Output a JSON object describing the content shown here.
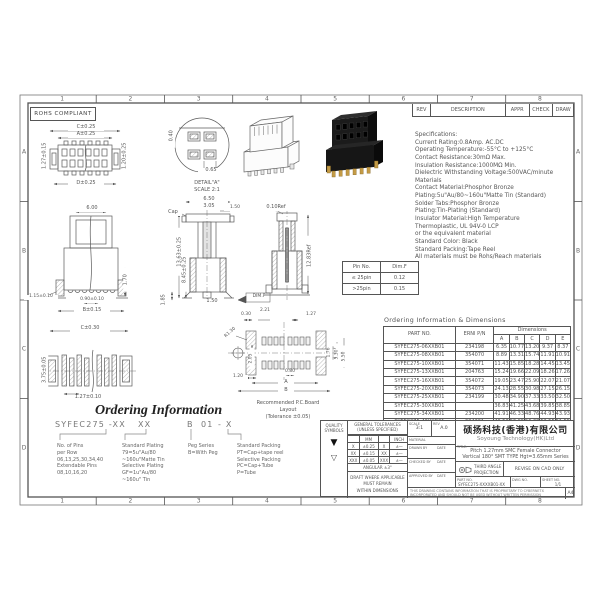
{
  "sheet": {
    "rohs": "ROHS COMPLIANT",
    "grid_cols": [
      "1",
      "2",
      "3",
      "4",
      "5",
      "6",
      "7",
      "8"
    ],
    "grid_rows": [
      "A",
      "B",
      "C",
      "D"
    ],
    "paper": "A4"
  },
  "rev_strip": {
    "rev": "REV",
    "description": "DESCRIPTION",
    "appr": "APPR",
    "check": "CHECK",
    "draw": "DRAW"
  },
  "specs": {
    "lines": [
      "Specifications:",
      "Current Rating:0.8Amp. AC.DC",
      "Operating Temperature:-55°C to +125°C",
      "Contact Resistance:30mΩ Max.",
      "Insulation Resistance:1000MΩ Min.",
      "Dielectric Withstanding Voltage:500VAC/minute",
      "Materials",
      "Contact Material:Phosphor Bronze",
      "Plating:5u\"Au/80~160u\"Matte Tin (Standard)",
      "Solder Tabs:Phosphor Bronze",
      "Plating:Tin-Plating (Standard)",
      "Insulator Material:High Temperature",
      "Thermoplastic, UL 94V-0 LCP",
      "or the equivalent material",
      "Standard Color: Black",
      "Standard Packing:Tape Reel",
      "All materials must be Rohs/Reach materials"
    ]
  },
  "pin_table": {
    "col1": "Pin No.",
    "col2": "Dim.F",
    "rows": [
      [
        "≤ 25pin",
        "0.12"
      ],
      [
        ">25pin",
        "0.15"
      ]
    ]
  },
  "dims_table": {
    "title": "Ordering Information & Dimensions",
    "col_part": "PART NO.",
    "col_erni": "ERNI P/N",
    "col_dims": "Dimensions",
    "dim_cols": [
      "A",
      "B",
      "C",
      "D",
      "E"
    ],
    "rows": [
      [
        "SYFEC275-06XXB01",
        "234198",
        "6.35",
        "10.77",
        "13.20",
        "9.37",
        "8.37"
      ],
      [
        "SYFEC275-08XXB01",
        "354070",
        "8.89",
        "13.31",
        "15.74",
        "11.91",
        "10.91"
      ],
      [
        "SYFEC275-10XXB01",
        "354071",
        "11.43",
        "15.85",
        "18.28",
        "14.45",
        "13.45"
      ],
      [
        "SYFEC275-13XXB01",
        "204763",
        "15.24",
        "19.66",
        "22.09",
        "18.26",
        "17.26"
      ],
      [
        "SYFEC275-16XXB01",
        "354072",
        "19.05",
        "23.47",
        "25.90",
        "22.07",
        "21.07"
      ],
      [
        "SYFEC275-20XXB01",
        "354073",
        "24.13",
        "28.55",
        "30.98",
        "27.15",
        "26.15"
      ],
      [
        "SYFEC275-25XXB01",
        "234199",
        "30.48",
        "34.90",
        "37.33",
        "33.50",
        "32.50"
      ],
      [
        "SYFEC275-30XXB01",
        "",
        "36.83",
        "41.25",
        "43.68",
        "39.85",
        "38.85"
      ],
      [
        "SYFEC275-34XXB01",
        "234200",
        "41.91",
        "46.33",
        "48.76",
        "44.93",
        "43.93"
      ],
      [
        "SYFEC275-40XXB01",
        "234201",
        "49.53",
        "53.95",
        "56.38",
        "52.55",
        "51.55"
      ]
    ]
  },
  "ordering": {
    "title": "Ordering Information",
    "code_parts": [
      "SYFEC275 -XX",
      "XX",
      "B",
      "01",
      "- X"
    ],
    "blocks": [
      [
        "No. of Pins",
        "per Row",
        "06,13,25,30,34,40",
        "Extendable Pins",
        "08,10,16,20"
      ],
      [
        "Standard Plating",
        "79=5u\"Au/80",
        "~160u\"Matte Tin",
        "Selective Plating",
        "GF=1u\"Au/80",
        "~160u\" Tin"
      ],
      [
        "Peg Series",
        "B=With Peg"
      ],
      [
        "Standard Packing",
        "PT=Cap+tape reel",
        "Selective Packing",
        "PC=Cap+Tube",
        "P=Tube"
      ]
    ]
  },
  "title_block": {
    "quality1": "QUALITY",
    "quality2": "SYMBOLS",
    "tol1": "GENERAL TOLERANCES",
    "tol2": "(UNLESS SPECIFIED)",
    "mm": "MM",
    "inch": "INCH",
    "tol_rows": [
      [
        "X",
        "±0.25",
        "X",
        "±—"
      ],
      [
        "XX",
        "±0.15",
        "XX",
        "±—"
      ],
      [
        "XXX",
        "±0.05",
        "XXX",
        "±—"
      ]
    ],
    "angular": "ANGULAR ±3°",
    "draft_lines": [
      "DRAFT WHERE APPLICABLE",
      "MUST REMAIN",
      "WITHIN DIMENSIONS"
    ],
    "scale_label": "SCALE",
    "scale_value": "3:1",
    "rev_label": "REV",
    "rev_value": "A.0",
    "material_label": "MATERIAL",
    "drawn_label": "DRAWN BY",
    "checked_label": "CHECKED BY",
    "approved_label": "APPROVED BY",
    "date_label": "DATE",
    "company_cn": "硕扬科技(香港)有限公司",
    "company_en": "Soyoung Technology(HK)Ltd",
    "title_label": "TITLE:",
    "title_line1": "Pitch 1.27mm SMC Female Connector",
    "title_line2": "Vertical 180° SMT TYPE Hgt=3.65mm Series",
    "third_angle1": "THIRD ANGLE",
    "third_angle2": "PROJECTION",
    "revise": "REVISE ON CAD ONLY",
    "part_label": "PART NO.",
    "part_value": "SYFEC275-XXXXB01-XX",
    "dwg_label": "DWG NO.",
    "sheet_label": "SHEET NO.",
    "sheet_value": "1/1",
    "disclaimer1": "THIS DRAWING CONTAINS INFORMATION THAT IS PROPRIETARY TO CYBERNETX",
    "disclaimer2": "INCORPORATED AND SHOULD NOT BE USED WITHOUT WRITTEN PERMISSION"
  },
  "icons": {
    "solid_triangle": "▼",
    "open_triangle": "▽"
  },
  "labels": {
    "c025": "C±0.25",
    "a025": "A±0.25",
    "d025": "D±0.25",
    "v127": "1.27±0.15",
    "v120": "1.20±0.25",
    "v040": "0.40",
    "v065": "0.65",
    "detail": "DETAIL\"A\"",
    "detail_scale": "SCALE 2:1",
    "v600": "6.00",
    "v170": "1.70",
    "v115": "1.15±0.10",
    "v090": "0.90±0.10",
    "vb015": "B±0.15",
    "v650": "6.50",
    "v305": "3.05",
    "v150": "1.50",
    "cap": "Cap",
    "v1363": "13.63±0.25",
    "v845": "8.45±0.25",
    "v150b": "1.50",
    "v185": "1.85",
    "dimf": "DIM.F",
    "v010": "0.10Ref",
    "v1283": "12.83Ref",
    "c030": "C±0.30",
    "v375": "3.75±0.05",
    "v127b": "1.27±0.10",
    "p030": "0.30",
    "p221": "2.21",
    "p127": "1.27",
    "r130": "R1.30",
    "p205": "2.05",
    "p176": "1.76",
    "p530": "5.30",
    "p550": "5.50",
    "p120": "1.20",
    "p080": "0.80",
    "pA": "A",
    "pB": "B",
    "pcb_caption": [
      "Recommended P.C.Board",
      "Layout",
      "(Tolerance ±0.05)"
    ]
  }
}
